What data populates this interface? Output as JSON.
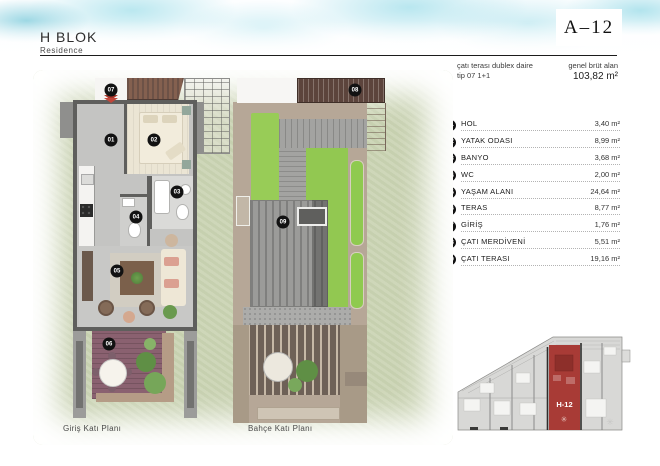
{
  "header": {
    "block_title": "H BLOK",
    "block_subtitle": "Residence",
    "unit_code": "A–12",
    "type_line1": "çatı terası dublex daire",
    "type_line2": "tip 07 1+1",
    "area_label": "genel brüt alan",
    "area_value": "103,82 m²"
  },
  "rooms": [
    {
      "no": "01",
      "label": "HOL",
      "area": "3,40 m²"
    },
    {
      "no": "02",
      "label": "YATAK ODASI",
      "area": "8,99 m²"
    },
    {
      "no": "03",
      "label": "BANYO",
      "area": "3,68 m²"
    },
    {
      "no": "04",
      "label": "WC",
      "area": "2,00 m²"
    },
    {
      "no": "05",
      "label": "YAŞAM ALANI",
      "area": "24,64 m²"
    },
    {
      "no": "06",
      "label": "TERAS",
      "area": "8,77 m²"
    },
    {
      "no": "07",
      "label": "GİRİŞ",
      "area": "1,76 m²"
    },
    {
      "no": "08",
      "label": "ÇATI MERDİVENİ",
      "area": "5,51 m²"
    },
    {
      "no": "09",
      "label": "ÇATI TERASI",
      "area": "19,16 m²"
    }
  ],
  "plan_labels": {
    "left": "Giriş Katı Planı",
    "right": "Bahçe Katı Planı"
  },
  "markers": [
    {
      "no": "07",
      "x": 111,
      "y": 90
    },
    {
      "no": "01",
      "x": 111,
      "y": 140
    },
    {
      "no": "02",
      "x": 154,
      "y": 140
    },
    {
      "no": "03",
      "x": 177,
      "y": 192
    },
    {
      "no": "04",
      "x": 136,
      "y": 217
    },
    {
      "no": "05",
      "x": 117,
      "y": 271
    },
    {
      "no": "06",
      "x": 109,
      "y": 344
    },
    {
      "no": "08",
      "x": 355,
      "y": 90
    },
    {
      "no": "09",
      "x": 283,
      "y": 222
    }
  ],
  "site_plan": {
    "unit_label": "H-12",
    "highlight_color": "#a83b36"
  },
  "colors": {
    "watercolor_cyan": "#9fdde9",
    "accent_red": "#a8362b",
    "lawn_green": "#96cb55",
    "deck_plum": "#8a6170",
    "taupe": "#b6a797",
    "stair_brown": "#5c443c"
  }
}
